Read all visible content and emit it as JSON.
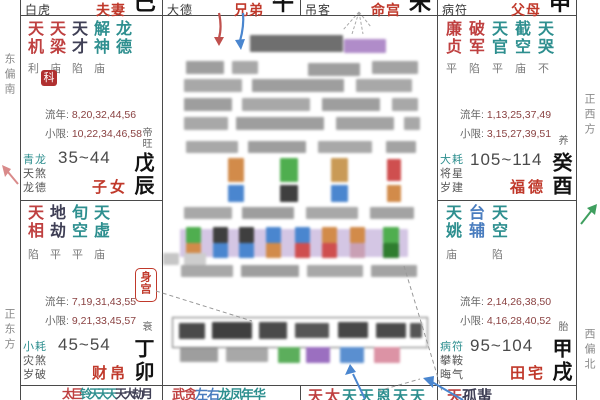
{
  "colors": {
    "palace_red": "#c0392b",
    "star_red": "#bf4040",
    "star_teal": "#2e8f8f",
    "star_blue": "#4a7dbf",
    "number_maroon": "#8a4242",
    "seal_red": "#b03030",
    "arrow_blue": "#4a86cf",
    "arrow_red": "#c0504d",
    "arrow_green": "#3f9f5f",
    "arrow_pink": "#d98a8a"
  },
  "compass": {
    "left_top": "东偏南",
    "left_bottom": "正东方",
    "right_top": "正西方",
    "right_bottom": "西偏北"
  },
  "labels": {
    "liunian": "流年:",
    "xiaoxian": "小限:",
    "body_palace": "身宫",
    "seal": "科"
  },
  "top_strip": [
    {
      "god": "白虎",
      "palace": "夫妻",
      "branch": "巳"
    },
    {
      "god": "大德",
      "palace": "兄弟",
      "branch": "午"
    },
    {
      "god": "吊客",
      "palace": "命宫",
      "branch": "未"
    },
    {
      "god": "病符",
      "palace": "父母",
      "branch": "申"
    }
  ],
  "palaces": {
    "chen": {
      "stars": [
        {
          "n": "天机",
          "b": "利"
        },
        {
          "n": "天梁",
          "b": "庙"
        },
        {
          "n": "天才",
          "b": "陷"
        },
        {
          "n": "解神",
          "b": "庙"
        },
        {
          "n": "龙德",
          "b": ""
        }
      ],
      "liunian": "8,20,32,44,56",
      "xiaoxian": "10,22,34,46,58",
      "gods": [
        "青龙",
        "天煞",
        "龙德"
      ],
      "ages": "35~44",
      "palace": "子女",
      "ganzhi": "戊辰",
      "stage": "帝旺"
    },
    "you": {
      "stars": [
        {
          "n": "廉贞",
          "b": "平"
        },
        {
          "n": "破军",
          "b": "陷"
        },
        {
          "n": "天官",
          "b": "平"
        },
        {
          "n": "截空",
          "b": "庙"
        },
        {
          "n": "天哭",
          "b": "不"
        }
      ],
      "liunian": "1,13,25,37,49",
      "xiaoxian": "3,15,27,39,51",
      "gods": [
        "大耗",
        "将星",
        "岁建"
      ],
      "ages": "105~114",
      "palace": "福德",
      "ganzhi": "癸酉",
      "stage": "养"
    },
    "mao": {
      "stars": [
        {
          "n": "天相",
          "b": "陷"
        },
        {
          "n": "地劫",
          "b": "平"
        },
        {
          "n": "旬空",
          "b": "平"
        },
        {
          "n": "天虚",
          "b": "庙"
        }
      ],
      "liunian": "7,19,31,43,55",
      "xiaoxian": "9,21,33,45,57",
      "gods": [
        "小耗",
        "灾煞",
        "岁破"
      ],
      "ages": "45~54",
      "palace": "财帛",
      "ganzhi": "丁卯",
      "stage": "衰"
    },
    "xu": {
      "stars": [
        {
          "n": "天姚",
          "b": "庙"
        },
        {
          "n": "台辅",
          "b": ""
        },
        {
          "n": "天空",
          "b": "陷"
        }
      ],
      "liunian": "2,14,26,38,50",
      "xiaoxian": "4,16,28,40,52",
      "gods": [
        "病符",
        "攀鞍",
        "晦气"
      ],
      "ages": "95~104",
      "palace": "田宅",
      "ganzhi": "甲戌",
      "stage": "胎"
    }
  },
  "bottom_strip": {
    "yin": [
      "太",
      "巨",
      "铃",
      "天",
      "天",
      "天",
      "天",
      "大",
      "劫",
      "月"
    ],
    "chou": [
      "武",
      "贪",
      "左",
      "右",
      "龙",
      "凤",
      "年",
      "华"
    ],
    "zi": [
      "天",
      "太",
      "天",
      "天",
      "恩",
      "天",
      "天"
    ],
    "hai": [
      "天",
      "孤",
      "蜚"
    ]
  },
  "censored_blocks": [
    [
      250,
      35,
      93,
      17,
      "#6f6f6f"
    ],
    [
      344,
      39,
      42,
      14,
      "#b08cc9"
    ],
    [
      186,
      61,
      38,
      13,
      "#9e9e9e"
    ],
    [
      232,
      61,
      26,
      13,
      "#a8a8a8"
    ],
    [
      308,
      63,
      52,
      13,
      "#9e9e9e"
    ],
    [
      372,
      61,
      46,
      13,
      "#a3a3a3"
    ],
    [
      184,
      79,
      58,
      13,
      "#a8a8a8"
    ],
    [
      252,
      79,
      92,
      13,
      "#9e9e9e"
    ],
    [
      356,
      79,
      56,
      13,
      "#a8a8a8"
    ],
    [
      184,
      98,
      48,
      13,
      "#9e9e9e"
    ],
    [
      242,
      98,
      68,
      13,
      "#a8a8a8"
    ],
    [
      322,
      98,
      58,
      13,
      "#9e9e9e"
    ],
    [
      392,
      98,
      26,
      13,
      "#a8a8a8"
    ],
    [
      184,
      117,
      44,
      13,
      "#a8a8a8"
    ],
    [
      236,
      117,
      88,
      13,
      "#9e9e9e"
    ],
    [
      336,
      117,
      58,
      13,
      "#a3a3a3"
    ],
    [
      404,
      117,
      16,
      13,
      "#a8a8a8"
    ],
    [
      186,
      141,
      52,
      12,
      "#a8a8a8"
    ],
    [
      248,
      141,
      58,
      12,
      "#9e9e9e"
    ],
    [
      318,
      141,
      54,
      12,
      "#a8a8a8"
    ],
    [
      386,
      141,
      30,
      12,
      "#a3a3a3"
    ],
    [
      228,
      158,
      16,
      24,
      "#d28b4a"
    ],
    [
      280,
      158,
      18,
      24,
      "#4fae4f"
    ],
    [
      331,
      158,
      17,
      24,
      "#c99a56"
    ],
    [
      387,
      159,
      14,
      22,
      "#cf4f4f"
    ],
    [
      228,
      185,
      16,
      17,
      "#4a86cf"
    ],
    [
      280,
      185,
      18,
      17,
      "#3f3f3f"
    ],
    [
      331,
      185,
      17,
      17,
      "#4a86cf"
    ],
    [
      387,
      185,
      14,
      17,
      "#d28b4a"
    ],
    [
      184,
      207,
      48,
      12,
      "#a8a8a8"
    ],
    [
      242,
      207,
      52,
      12,
      "#9e9e9e"
    ],
    [
      306,
      207,
      52,
      12,
      "#a8a8a8"
    ],
    [
      370,
      207,
      44,
      12,
      "#a3a3a3"
    ],
    [
      180,
      229,
      228,
      28,
      "#d4c6e4"
    ],
    [
      186,
      227,
      15,
      16,
      "#4fae4f"
    ],
    [
      186,
      243,
      15,
      15,
      "#d28b4a"
    ],
    [
      213,
      227,
      15,
      16,
      "#3f3f3f"
    ],
    [
      213,
      243,
      15,
      15,
      "#4a86cf"
    ],
    [
      239,
      227,
      15,
      16,
      "#3f3f3f"
    ],
    [
      239,
      243,
      15,
      15,
      "#4a86cf"
    ],
    [
      266,
      227,
      15,
      16,
      "#4a86cf"
    ],
    [
      266,
      243,
      15,
      15,
      "#d28b4a"
    ],
    [
      295,
      227,
      15,
      16,
      "#4a86cf"
    ],
    [
      295,
      243,
      15,
      15,
      "#cf4f4f"
    ],
    [
      322,
      227,
      15,
      16,
      "#d28b4a"
    ],
    [
      322,
      243,
      15,
      15,
      "#cf4f4f"
    ],
    [
      350,
      227,
      15,
      16,
      "#d28b4a"
    ],
    [
      350,
      243,
      15,
      15,
      "#c9a0b4"
    ],
    [
      383,
      227,
      16,
      16,
      "#4fae4f"
    ],
    [
      383,
      243,
      16,
      15,
      "#2f7d2f"
    ],
    [
      163,
      253,
      16,
      12,
      "#c6c6c6"
    ],
    [
      184,
      253,
      22,
      12,
      "#cdcdcd"
    ],
    [
      181,
      265,
      52,
      12,
      "#a8a8a8"
    ],
    [
      241,
      265,
      58,
      12,
      "#9e9e9e"
    ],
    [
      307,
      265,
      56,
      12,
      "#a8a8a8"
    ],
    [
      371,
      265,
      46,
      12,
      "#a3a3a3"
    ],
    [
      179,
      323,
      26,
      16,
      "#4a4a4a"
    ],
    [
      212,
      322,
      40,
      17,
      "#3f3f3f"
    ],
    [
      259,
      322,
      28,
      17,
      "#4a4a4a"
    ],
    [
      295,
      323,
      34,
      15,
      "#565656"
    ],
    [
      338,
      322,
      30,
      16,
      "#474747"
    ],
    [
      376,
      323,
      30,
      15,
      "#4a4a4a"
    ],
    [
      410,
      323,
      12,
      15,
      "#565656"
    ],
    [
      180,
      348,
      38,
      14,
      "#9e9e9e"
    ],
    [
      226,
      348,
      42,
      14,
      "#a8a8a8"
    ],
    [
      278,
      347,
      22,
      16,
      "#5cae5c"
    ],
    [
      306,
      347,
      24,
      16,
      "#9b6fc0"
    ],
    [
      340,
      347,
      24,
      16,
      "#5a8fd0"
    ],
    [
      374,
      347,
      26,
      16,
      "#dc93a5"
    ]
  ]
}
